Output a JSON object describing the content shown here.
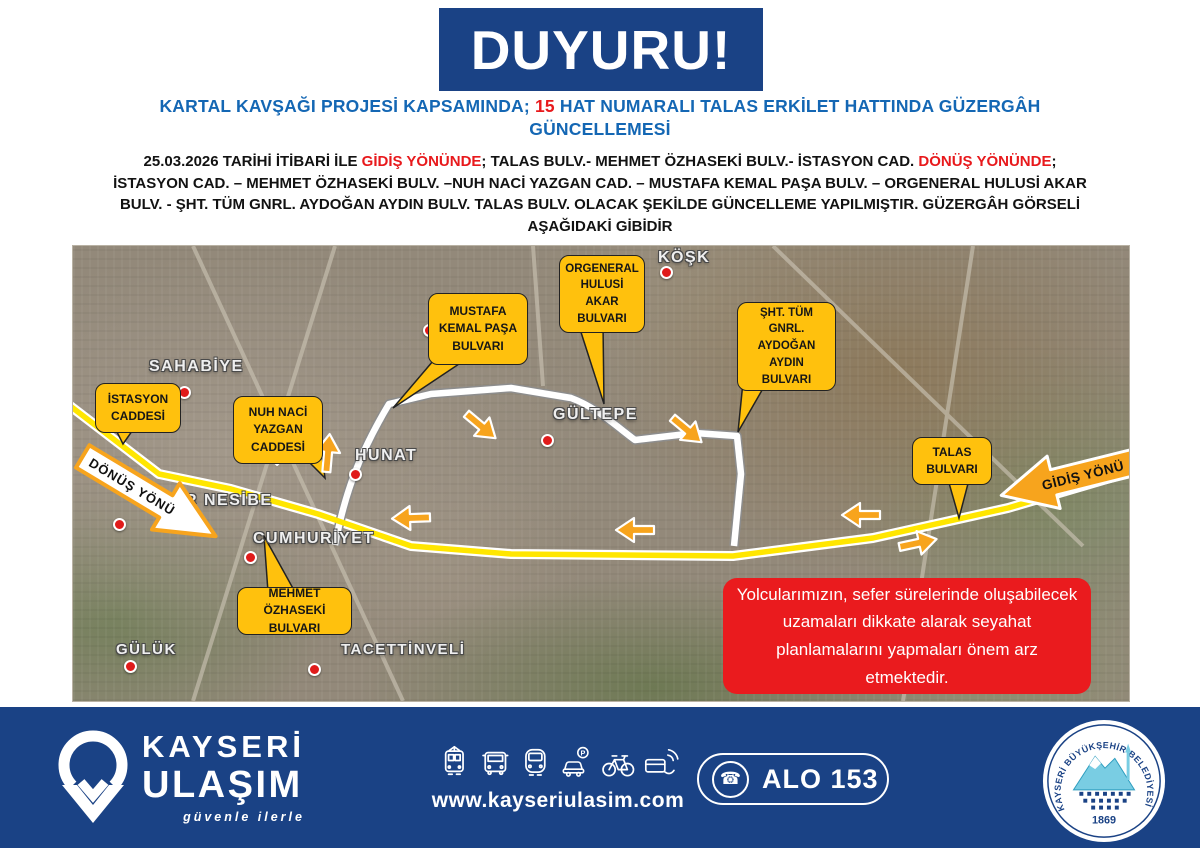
{
  "banner": {
    "title": "DUYURU!"
  },
  "heading": {
    "line1_pre": "KARTAL KAVŞAĞI PROJESİ KAPSAMINDA; ",
    "line1_number": "15",
    "line1_post": " HAT NUMARALI TALAS ERKİLET HATTINDA GÜZERGÂH",
    "line2": "GÜNCELLEMESİ"
  },
  "body": {
    "line1_a": "25.03.2026 TARİHİ İTİBARİ İLE ",
    "line1_red1": "GİDİŞ YÖNÜNDE",
    "line1_b": "; TALAS BULV.- MEHMET ÖZHASEKİ BULV.- İSTASYON CAD. ",
    "line1_red2": "DÖNÜŞ YÖNÜNDE",
    "line1_c": ";",
    "line2": "İSTASYON CAD. – MEHMET ÖZHASEKİ BULV. –NUH NACİ YAZGAN CAD. – MUSTAFA KEMAL PAŞA BULV. – ORGENERAL HULUSİ AKAR",
    "line3": "BULV. - ŞHT. TÜM GNRL. AYDOĞAN AYDIN BULV.  TALAS BULV. OLACAK ŞEKİLDE GÜNCELLEME YAPILMIŞTIR. GÜZERGÂH GÖRSELİ",
    "line4": "AŞAĞIDAKİ GİBİDİR"
  },
  "map": {
    "callouts": [
      {
        "name": "istasyon-caddesi",
        "text": "İSTASYON\nCADDESİ"
      },
      {
        "name": "nuh-naci-yazgan-caddesi",
        "text": "NUH NACİ\nYAZGAN\nCADDESİ"
      },
      {
        "name": "mustafa-kemal-pasa-bulvari",
        "text": "MUSTAFA\nKEMAL PAŞA\nBULVARI"
      },
      {
        "name": "orgeneral-hulusi-akar-bulvari",
        "text": "ORGENERAL\nHULUSİ\nAKAR\nBULVARI"
      },
      {
        "name": "sht-tum-gnrl-aydogan-aydin-bulvari",
        "text": "ŞHT. TÜM\nGNRL.\nAYDOĞAN\nAYDIN\nBULVARI"
      },
      {
        "name": "talas-bulvari",
        "text": "TALAS\nBULVARI"
      },
      {
        "name": "mehmet-ozhaseki-bulvari",
        "text": "MEHMET ÖZHASEKİ\nBULVARI"
      }
    ],
    "places": [
      {
        "name": "sahabiye",
        "text": "SAHABİYE"
      },
      {
        "name": "r-nesibe",
        "text": "R NESİBE"
      },
      {
        "name": "cumhuriyet",
        "text": "CUMHURİYET"
      },
      {
        "name": "hunat",
        "text": "HUNAT"
      },
      {
        "name": "gultepe",
        "text": "GÜLTEPE"
      },
      {
        "name": "kosk",
        "text": "KÖŞK"
      },
      {
        "name": "guluk",
        "text": "GÜLÜK"
      },
      {
        "name": "tacettinveli",
        "text": "TACETTİNVELİ"
      }
    ],
    "arrows": {
      "donus": "DÖNÜŞ YÖNÜ",
      "gidis": "GİDİŞ YÖNÜ"
    },
    "notice": "Yolcularımızın, sefer sürelerinde oluşabilecek\nuzamaları dikkate alarak seyahat\nplanlamalarını yapmaları önem arz\netmektedir.",
    "route_colors": {
      "gidis_route": "#FFE600",
      "diverted_route": "#FFFFFF",
      "callout_fill": "#FFC10D",
      "arrow_fill": "#F7A41D"
    }
  },
  "footer": {
    "brand_line1": "KAYSERİ",
    "brand_line2": "ULAŞIM",
    "tagline": "güvenle ilerle",
    "website": "www.kayseriulasim.com",
    "hotline": "ALO 153",
    "seal_text": "KAYSERİ BÜYÜKŞEHİR BELEDİYESİ",
    "seal_year": "1869",
    "icons": [
      "tram-icon",
      "bus-icon",
      "metro-icon",
      "car-parking-icon",
      "bicycle-icon",
      "contactless-payment-icon"
    ]
  },
  "colors": {
    "primary_blue": "#1A4285",
    "heading_blue": "#1467B4",
    "alert_red": "#E8191C"
  }
}
